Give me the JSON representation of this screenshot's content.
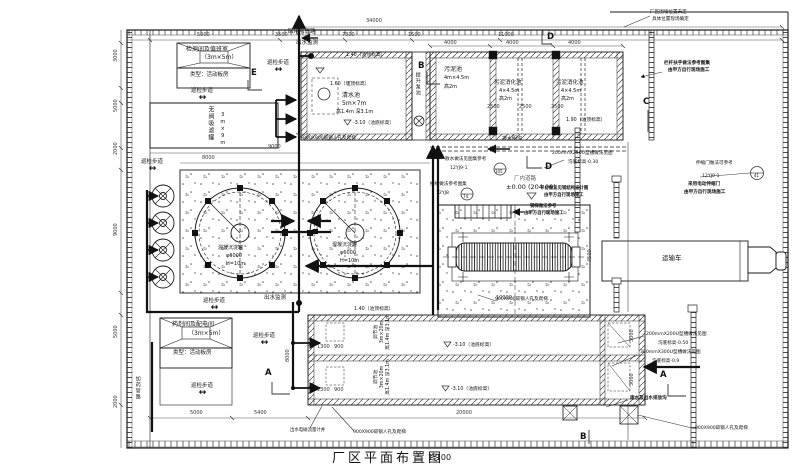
{
  "drawing": {
    "title": "厂区平面布置图",
    "scale": "1:100",
    "colors": {
      "line": "#1a1a1a",
      "dim_text": "#333333",
      "background": "#ffffff"
    },
    "arrows": {
      "lr": "↔"
    },
    "labels": {
      "inspection_room_1": "检测间及值班室",
      "inspection_room_2": "（3m×5m）",
      "panel_house": "类型：活动板房",
      "dosing_room_1": "药剂间及配电间",
      "dosing_room_2": "（3m×5m）",
      "walkway": "巡检步道",
      "reuse_pipe": "回用水管路",
      "outlet_monitor": "出水监测",
      "no_valve_filter": "无阀吸滤罐",
      "no_valve_filter_size": "3m×9m",
      "clear_water": "清水池",
      "clear_water_size": "5m×7m",
      "clear_water_hd": "高1.4m 深3.1m",
      "lift_pump": "提升泵池",
      "sludge_tank": "污泥池",
      "sludge_tank_size": "4m×4.5m",
      "sludge_h": "高2m",
      "digestion_tank": "污泥消化池",
      "digestion_size": "4×4.5m",
      "drain_ditch": "排水明沟",
      "coag_tank": "混凝沉淀罐",
      "coag_d": "φ6000",
      "coag_h": "H=10m",
      "eq_tank": "调节池",
      "eq_size": "3m×20m",
      "eq_hd": "高1.4m 深3.1m",
      "transport_truck": "运输车",
      "manhole": "900X900碳钢人孔及爬梯",
      "flow_meter": "出水电磁流量计井",
      "dosing_pipe": "加药管路",
      "road": "厂内道路",
      "road_level": "±0.00 (204.00)"
    },
    "levels": {
      "top_140": "1.40（池顶标高）",
      "weir_160": "1.60（堰顶标高）",
      "bottom_310": "-3.10（池底标高）",
      "top_190": "1.90（池顶标高）"
    },
    "notes": {
      "fence_1": "厂区围墙位置未定",
      "fence_2": "具体位置现场确定",
      "rail_1": "栏杆扶手做法参考图集",
      "rail_2": "由甲方自行现场施工",
      "u250_1": "200mmX250U型槽做法见图",
      "u250_2": "沟底标高-0.30",
      "gate_1": "伸缩门做法可参考",
      "gate_ref": "12YJ9-1",
      "gate_no": "41",
      "egate_1": "采用电动伸缩门",
      "egate_2": "由甲方自行现场施工",
      "splash_1": "散水做法见图集参考",
      "splash_ref": "12YJ9-1",
      "splash_no": "105",
      "stair_1": "楼梯做法参考图集",
      "stair_ref": "12YJ8",
      "stair_no": "74",
      "plat_1": "平台做法见钢结构设计图",
      "plat_2": "由甲方自行现场施工",
      "steel_1": "钢梯做法参考",
      "steel_2": "由甲方自行现场施工",
      "u200_1": "200mmX200U型槽做法见图",
      "u200_2": "沟底标高-0.50",
      "u300_1": "300mmX300U型槽做法见图",
      "u300_2": "沟底标高-0.9",
      "rain": "雨水及出水排放沟"
    },
    "dims": {
      "d34000": "34000",
      "d5000": "5000",
      "d3500": "3500",
      "d7300": "7300",
      "d1500": "1500",
      "d11000": "11000",
      "d4000": "4000",
      "d9000": "9000",
      "d8000": "8000",
      "d2500": "2500",
      "d20000": "20000",
      "d5400": "5400",
      "d10000": "10000",
      "d4500": "4500",
      "d3000": "3000",
      "d2000": "2000",
      "d1300": "1300",
      "d900": "900"
    },
    "markers": {
      "a": "A",
      "b": "B",
      "c": "C",
      "d": "D",
      "e": "E"
    }
  }
}
